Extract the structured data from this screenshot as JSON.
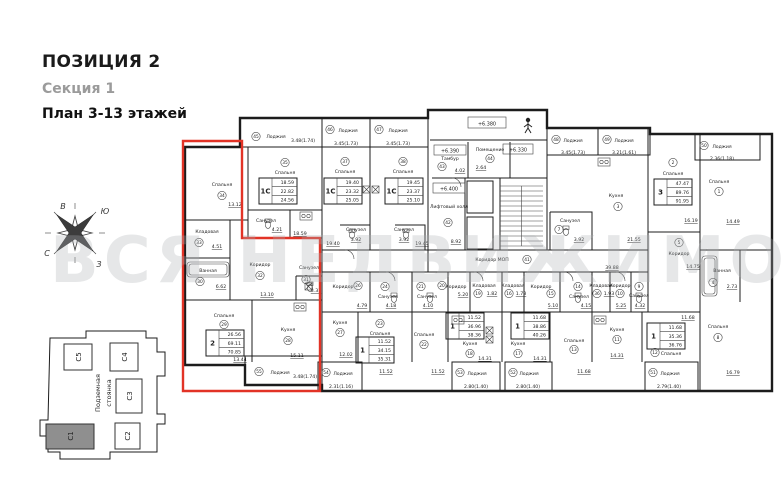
{
  "header": {
    "position": "ПОЗИЦИЯ 2",
    "section": "Секция 1",
    "plan": "План 3-13 этажей"
  },
  "watermark": "ВСЯ НЕДВИЖИМОСТЬ",
  "compass": {
    "e": "В",
    "s": "Ю",
    "n": "С",
    "w": "З"
  },
  "site": {
    "s1": "С1",
    "s2": "С2",
    "s3": "С3",
    "s4": "С4",
    "s5": "С5",
    "parking1": "Подземная",
    "parking2": "стоянка"
  },
  "core": {
    "elev_balcony": "+6.380",
    "elev_tambour": "+6.390",
    "elev_landing": "+6.330",
    "elev_hall": "+6.400"
  },
  "loggia_label": "Лоджия",
  "rooms": {
    "r34": {
      "n": "Спальня",
      "c": "34",
      "a": "13.12"
    },
    "r35": {
      "n": "Спальня",
      "c": "35",
      "a": "18.59"
    },
    "b35": {
      "n": "Санузел",
      "c": "",
      "a": "4.21"
    },
    "r33": {
      "n": "Кладовая",
      "c": "33",
      "a": "4.51"
    },
    "r30": {
      "n": "Ванная",
      "c": "30",
      "a": "6.62"
    },
    "r32": {
      "n": "Коридор",
      "c": "32",
      "a": "13.10"
    },
    "r31": {
      "n": "Санузел",
      "c": "31",
      "a": "3.31"
    },
    "r29": {
      "n": "Спальня",
      "c": "29",
      "a": "13.44"
    },
    "r28": {
      "n": "Кухня",
      "c": "28",
      "a": "15.11"
    },
    "r37": {
      "n": "Спальня",
      "c": "37",
      "a": "19.40"
    },
    "b37": {
      "n": "Санузел",
      "c": "",
      "a": "3.92"
    },
    "r38": {
      "n": "Спальня",
      "c": "38",
      "a": "19.45"
    },
    "b38": {
      "n": "Санузел",
      "c": "",
      "a": "3.92"
    },
    "r43": {
      "n": "Тамбур",
      "c": "43",
      "a": "4.02"
    },
    "r44": {
      "n": "Помещение",
      "c": "44",
      "a": "2.64"
    },
    "r42": {
      "n": "Лифтовый холл",
      "c": "42",
      "a": "8.92"
    },
    "r41": {
      "n": "Коридор МОП",
      "c": "41",
      "a": "39.88"
    },
    "r3": {
      "n": "Кухня",
      "c": "3",
      "a": "21.55"
    },
    "r7": {
      "n": "Санузел",
      "c": "7",
      "a": "3.92"
    },
    "r2": {
      "n": "Спальня",
      "c": "2",
      "a": "16.19"
    },
    "r1": {
      "n": "Спальня",
      "c": "1",
      "a": "14.49"
    },
    "r5": {
      "n": "Коридор",
      "c": "5",
      "a": "14.75"
    },
    "r4": {
      "n": "Ванная",
      "c": "4",
      "a": "2.73"
    },
    "r8": {
      "n": "Спальня",
      "c": "8",
      "a": "16.79"
    },
    "r26": {
      "n": "Коридор",
      "c": "26",
      "a": "4.79"
    },
    "r24": {
      "n": "Санузел",
      "c": "24",
      "a": "4.18"
    },
    "r27": {
      "n": "Кухня",
      "c": "27",
      "a": "12.02"
    },
    "r23": {
      "n": "Спальня",
      "c": "23",
      "a": "11.52"
    },
    "r21": {
      "n": "Санузел",
      "c": "21",
      "a": "4.10"
    },
    "r20": {
      "n": "Коридор",
      "c": "20",
      "a": "5.20"
    },
    "r19": {
      "n": "Кладовая",
      "c": "19",
      "a": "1.82"
    },
    "r22": {
      "n": "Спальня",
      "c": "22",
      "a": "11.52"
    },
    "r18": {
      "n": "Кухня",
      "c": "18",
      "a": "14.31"
    },
    "r16": {
      "n": "Кладовая",
      "c": "16",
      "a": "1.73"
    },
    "r15": {
      "n": "Коридор",
      "c": "15",
      "a": "5.10"
    },
    "r14": {
      "n": "Санузел",
      "c": "14",
      "a": "4.15"
    },
    "r17": {
      "n": "Кухня",
      "c": "17",
      "a": "14.31"
    },
    "r13": {
      "n": "Спальня",
      "c": "13",
      "a": "11.68"
    },
    "r36": {
      "n": "Кладовая",
      "c": "36",
      "a": "1.93"
    },
    "r10": {
      "n": "Коридор",
      "c": "10",
      "a": "5.25"
    },
    "r9": {
      "n": "Санузел",
      "c": "9",
      "a": "4.32"
    },
    "r11": {
      "n": "Кухня",
      "c": "11",
      "a": "14.31"
    },
    "r12": {
      "n": "Спальня",
      "c": "12",
      "a": "11.68"
    }
  },
  "tables": {
    "u2": {
      "t": "2",
      "r": [
        "26.56",
        "69.11",
        "70.85"
      ]
    },
    "u35": {
      "t": "1С",
      "r": [
        "18.59",
        "22.82",
        "24.56"
      ]
    },
    "u37": {
      "t": "1С",
      "r": [
        "19.40",
        "23.32",
        "25.05"
      ]
    },
    "u38": {
      "t": "1С",
      "r": [
        "19.45",
        "23.37",
        "25.10"
      ]
    },
    "u3": {
      "t": "3",
      "r": [
        "47.47",
        "89.76",
        "91.95"
      ]
    },
    "uA": {
      "t": "1",
      "r": [
        "11.52",
        "34.15",
        "35.31"
      ]
    },
    "uB": {
      "t": "1",
      "r": [
        "11.52",
        "36.96",
        "38.36"
      ]
    },
    "uC": {
      "t": "1",
      "r": [
        "11.68",
        "38.86",
        "40.26"
      ]
    },
    "uD": {
      "t": "1",
      "r": [
        "11.68",
        "35.36",
        "36.76"
      ]
    }
  },
  "loggias": {
    "l45": {
      "num": "45",
      "dims": "3.48(1.74)"
    },
    "l46": {
      "num": "46",
      "dims": "3.45(1.73)"
    },
    "l47": {
      "num": "47",
      "dims": "3.45(1.73)"
    },
    "l48": {
      "num": "48",
      "dims": "3.45(1.73)"
    },
    "l49": {
      "num": "49",
      "dims": "3.21(1.61)"
    },
    "l50": {
      "num": "50",
      "dims": "2.36(1.18)"
    },
    "l51": {
      "num": "51",
      "dims": "2.79(1.40)"
    },
    "l52": {
      "num": "52",
      "dims": "2.80(1.40)"
    },
    "l53": {
      "num": "53",
      "dims": "2.80(1.40)"
    },
    "l54": {
      "num": "54",
      "dims": "2.31(1.16)"
    },
    "l55": {
      "num": "55",
      "dims": "3.48(1.74)"
    }
  }
}
